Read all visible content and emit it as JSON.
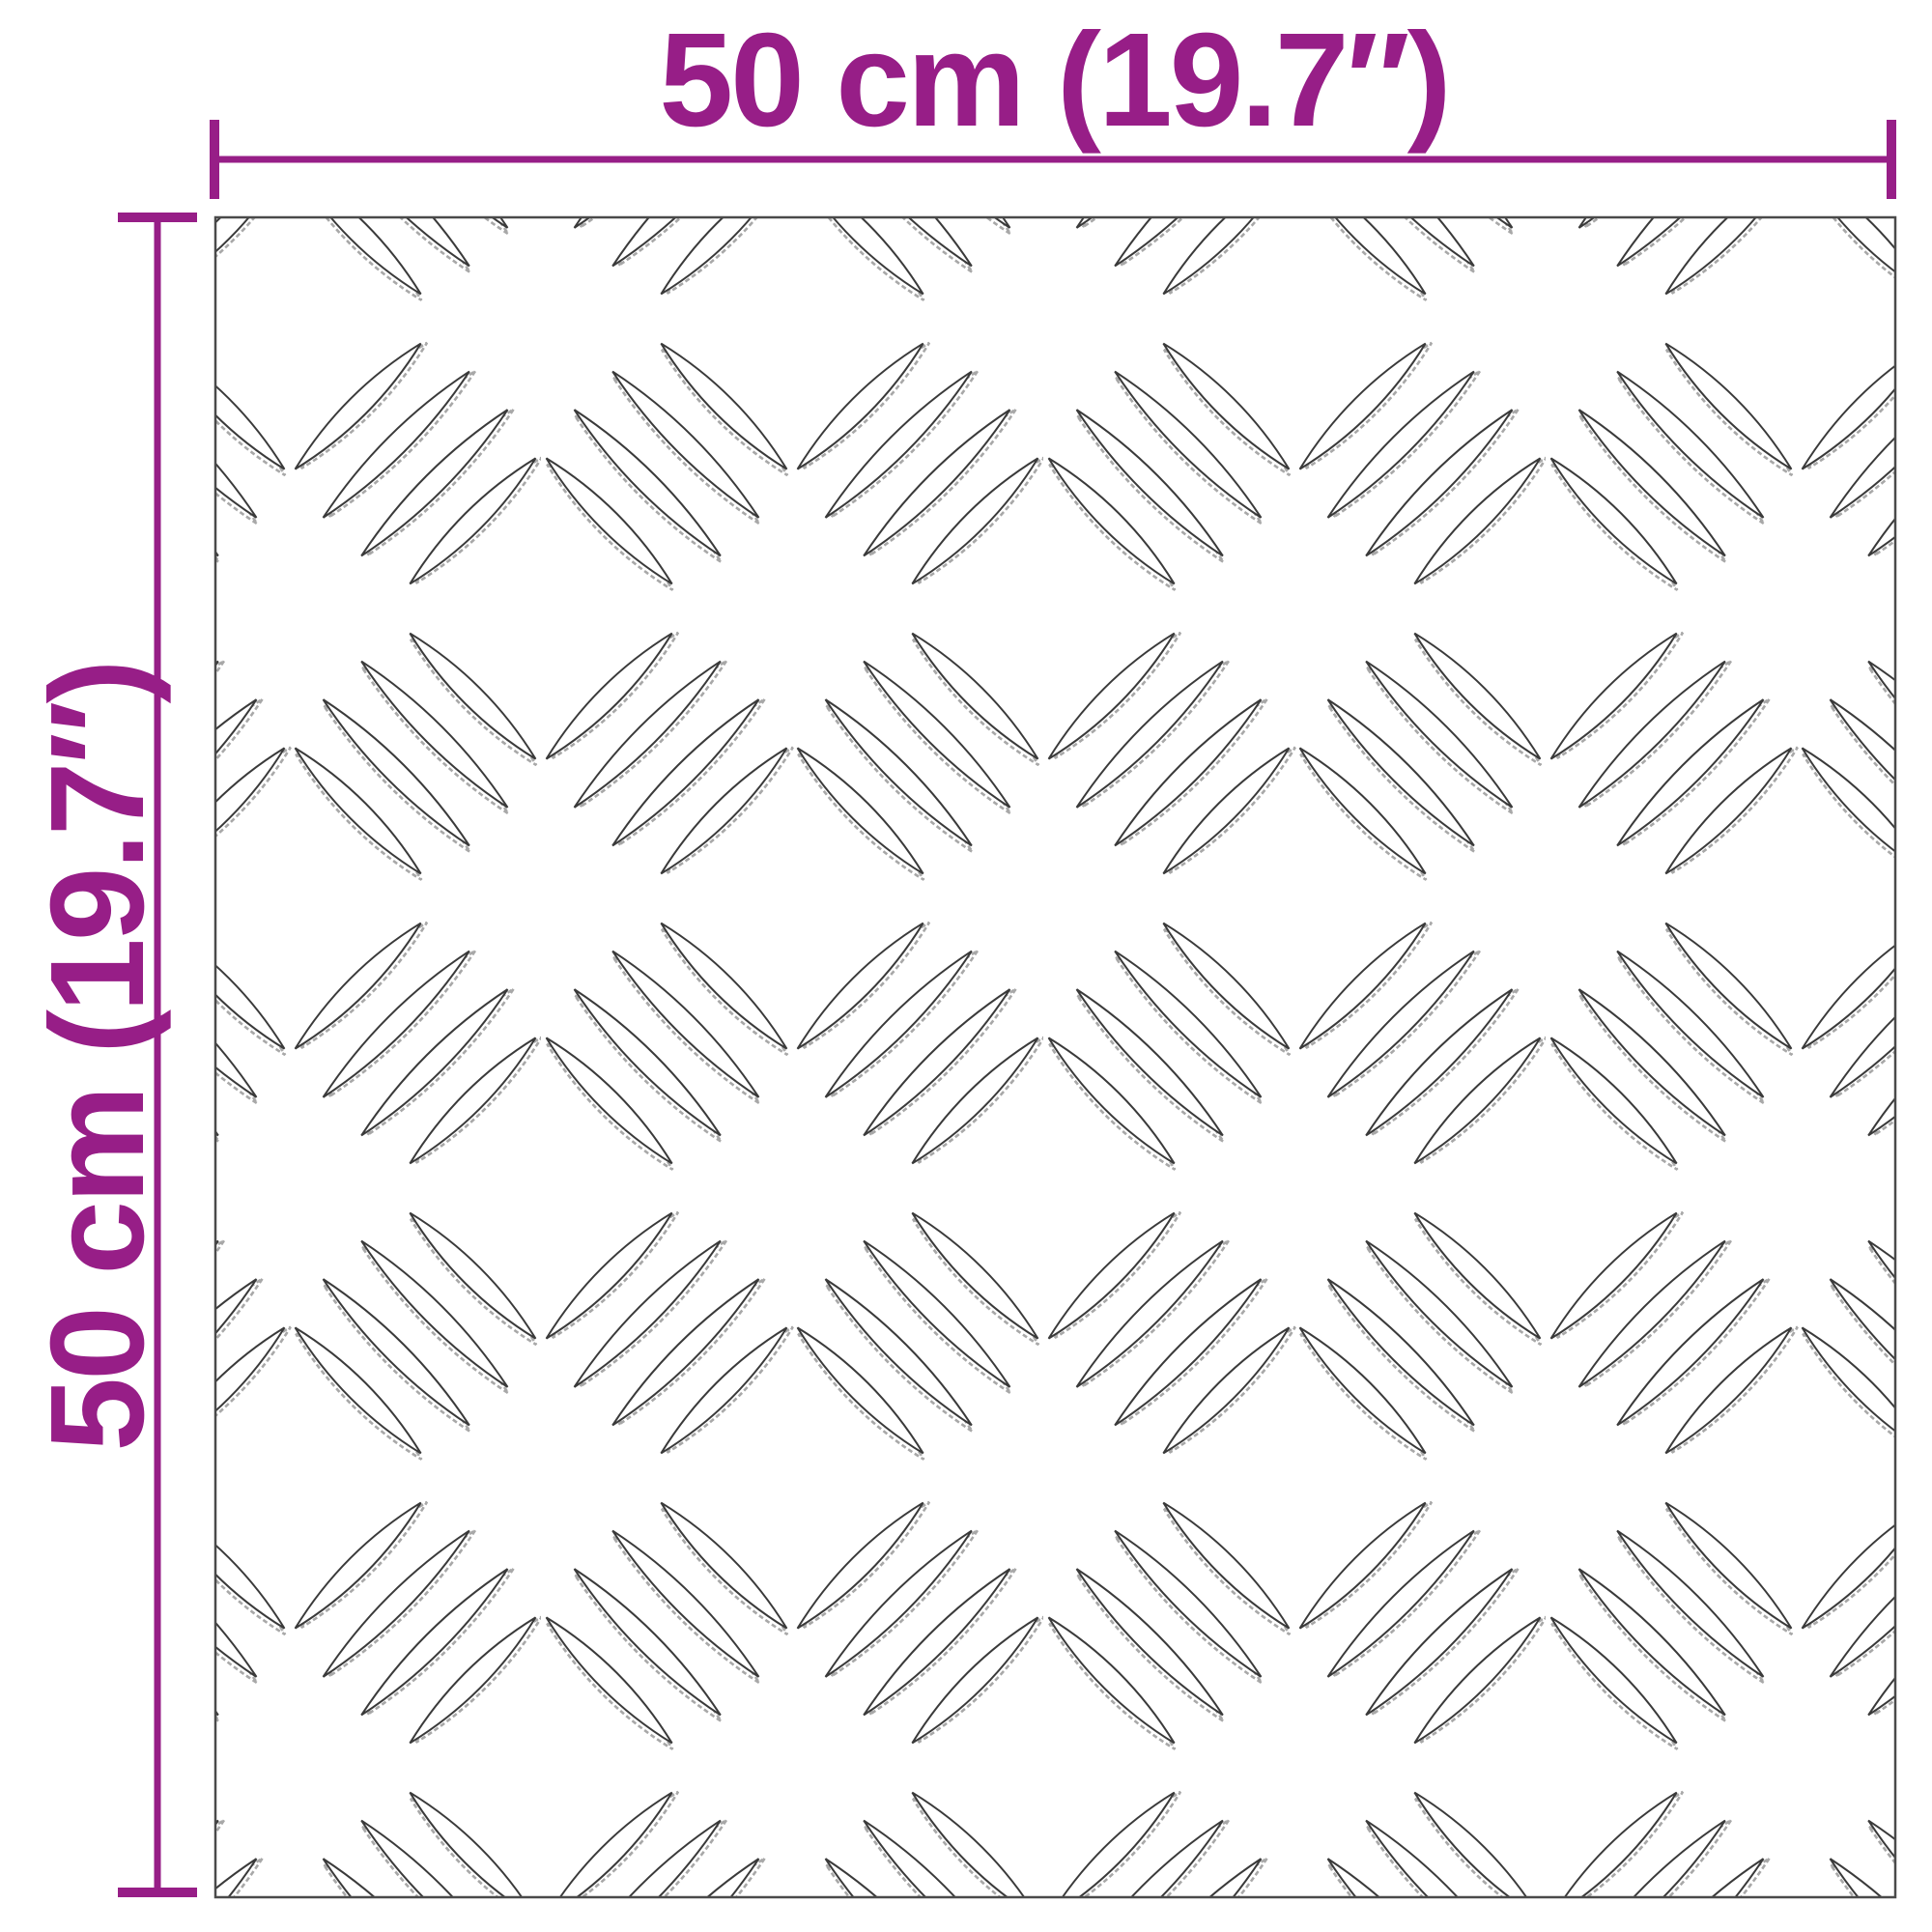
{
  "page": {
    "background": "#ffffff"
  },
  "diagram": {
    "type": "product-dimension-diagram",
    "width_dimension": {
      "label": "50 cm (19.7″)",
      "position": "top"
    },
    "height_dimension": {
      "label": "50 cm (19.7″)",
      "position": "left",
      "rotation_deg": -90
    },
    "plate": {
      "kind": "checker-plate-sheet",
      "pattern": "five-bar-tread",
      "fill": "#ffffff",
      "outline_color": "#3a3a3a",
      "border_color": "#4a4a4a"
    },
    "accent_color": "#971E87"
  }
}
